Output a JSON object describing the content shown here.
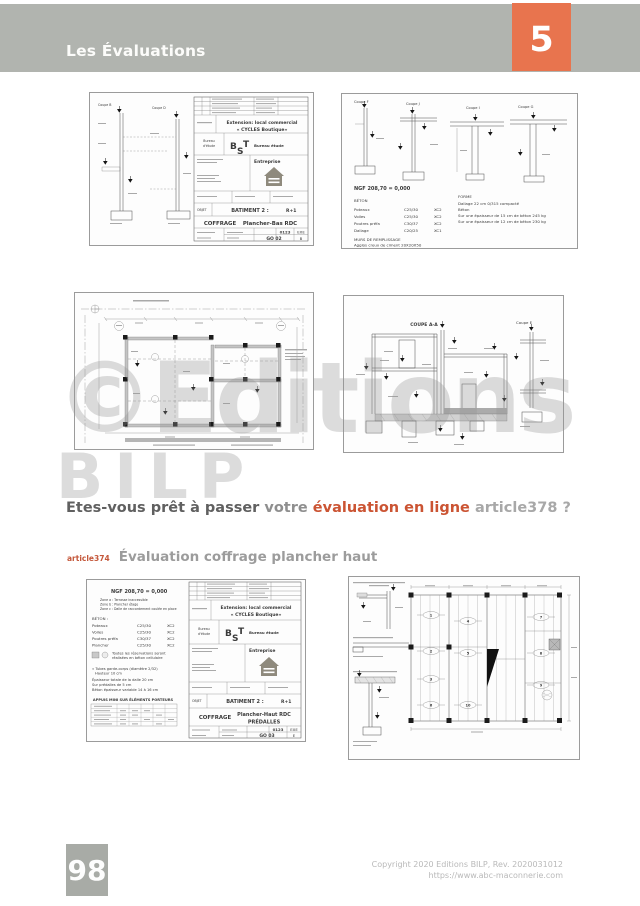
{
  "header": {
    "title": "Les Évaluations",
    "chapter_number": "5"
  },
  "watermark": {
    "line1": "©Editions",
    "line2": "BILP"
  },
  "question": {
    "part1": "Etes-vous prêt à passer",
    "part2": "votre",
    "highlight": "évaluation en ligne",
    "article_ref": "article378 ?"
  },
  "section_heading": {
    "article_ref": "article374",
    "title": "Évaluation coffrage plancher haut"
  },
  "footer": {
    "page_number": "98",
    "copyright_line1": "Copyright 2020 Editions BILP, Rev. 2020031012",
    "copyright_line2": "https://www.abc-maconnerie.com"
  },
  "colors": {
    "accent_orange": "#e8744e",
    "highlight_orange": "#cb5433",
    "header_gray": "#b1b4af",
    "page_number_gray": "#a8aba6"
  },
  "panels": {
    "coffrage_bas": {
      "coupe_left": "Coupe B",
      "coupe_right": "Coupe D",
      "title_block": {
        "project_line1": "Extension: local commercial",
        "project_line2": "« CYCLES Boutique»",
        "bureau_label_1": "Bureau",
        "bureau_label_2": "d'étude",
        "logo_b": "B",
        "logo_s": "S",
        "logo_t": "T",
        "bureau_name": "Bureau étude",
        "entreprise_label": "Entreprise",
        "objet_label": "OBJET",
        "batiment": "BATIMENT 2 :",
        "niveau": "R+1",
        "doc_type": "COFFRAGE",
        "doc_title": "Plancher-Bas RDC",
        "code": "0123",
        "phase": "EXE",
        "num": "GO 02",
        "index": "B"
      }
    },
    "coupes_beton": {
      "labels": [
        "Coupe F",
        "Coupe J",
        "Coupe I",
        "Coupe G"
      ],
      "ngf": "NGF 208,70 = 0,000",
      "beton_title": "BÉTON",
      "rows": [
        [
          "Poteaux",
          "C25/30",
          "XC2"
        ],
        [
          "Voiles",
          "C25/30",
          "XC2"
        ],
        [
          "Poutres préfa",
          "C30/37",
          "XC2"
        ],
        [
          "Dallage",
          "C20/25",
          "XC1"
        ]
      ],
      "murs1": "MURS DE REMPLISSAGE",
      "murs2": "Agglos creux de ciment 20X20X50",
      "forme_title": "FORME",
      "forme1": "Dallage 22 cm 0/315 compacté",
      "forme2": "Béton",
      "forme3": "Sur une épaisseur de 15 cm de béton 245 kg",
      "forme4": "Sur une épaisseur de 12 cm de béton 230 kg"
    },
    "coupe_aa": {
      "title": "COUPE A-A",
      "coupe_e": "Coupe E"
    },
    "coffrage_haut": {
      "ngf": "NGF 208,70 = 0,000",
      "zone_a": "Zone a :  Terrasse inaccessible",
      "zone_b": "Zone b :  Plancher étage",
      "zone_c": "Zone c :  Dalle de raccordement coulée en place",
      "beton_title": "BÉTON :",
      "rows": [
        [
          "Poteaux",
          "C25/30",
          "XC2"
        ],
        [
          "Voiles",
          "C25/30",
          "XC2"
        ],
        [
          "Poutres préfa",
          "C30/37",
          "XC2"
        ],
        [
          "Plancher",
          "C25/30",
          "XC2"
        ]
      ],
      "legend1": "Toutes les réservations seront",
      "legend2": "réalisées en béton cellulaire",
      "note1": "« Tubes garde-corps (diamètre 2/32)",
      "note2": "Hauteur 10 cm",
      "note3": "Épaisseur totale de la dalle 20 cm",
      "note4": "Sur prédalles de 5 cm",
      "note5": "Béton épaisseur variable 14 à 16 cm",
      "appuis_title": "APPUIS MINI SUR ÉLÉMENTS PORTEURS",
      "title_block": {
        "project_line1": "Extension: local commercial",
        "project_line2": "« CYCLES Boutique»",
        "bureau_label_1": "Bureau",
        "bureau_label_2": "d'étude",
        "logo_b": "B",
        "logo_s": "S",
        "logo_t": "T",
        "bureau_name": "Bureau étude",
        "entreprise_label": "Entreprise",
        "objet_label": "OBJET",
        "batiment": "BATIMENT 2 :",
        "niveau": "R+1",
        "doc_type": "COFFRAGE",
        "doc_title": "Plancher-Haut RDC",
        "doc_title2": "PRÉDALLES",
        "code": "0123",
        "phase": "EXE",
        "num": "GO 03",
        "index": "E"
      }
    },
    "predalles_plan": {
      "numbers": [
        "1",
        "2",
        "3",
        "4",
        "5",
        "6",
        "7",
        "8",
        "9",
        "10"
      ]
    }
  }
}
